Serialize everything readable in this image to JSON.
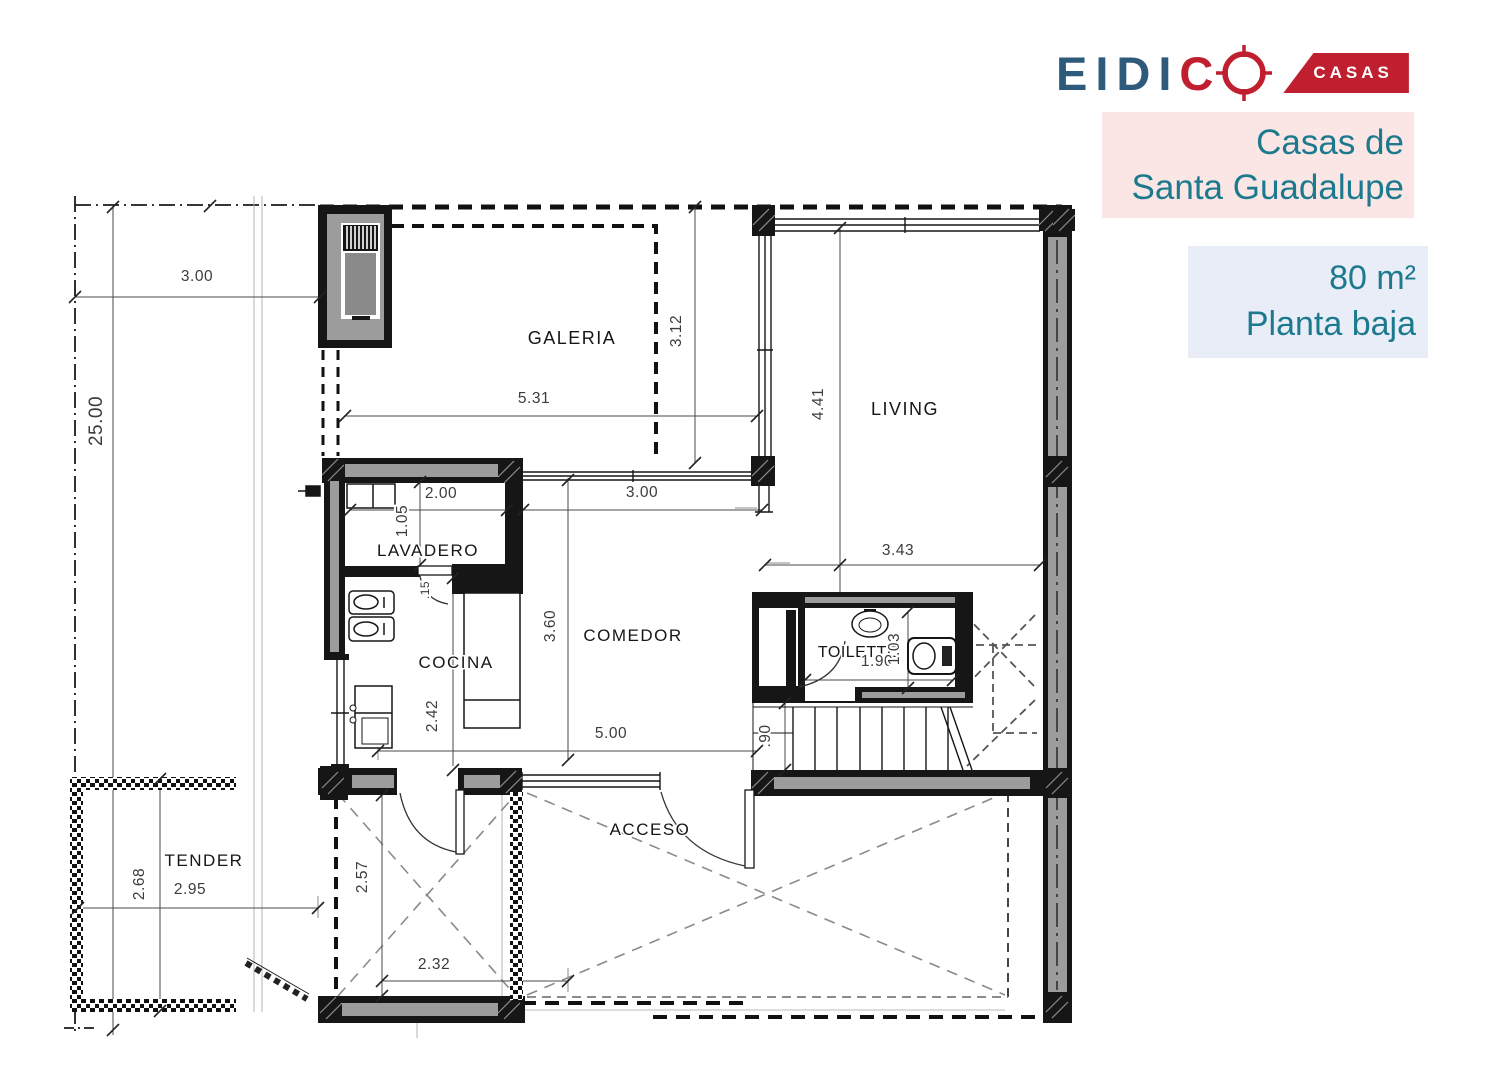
{
  "brand": {
    "logo_text_primary": "EIDI",
    "logo_text_accent": "C",
    "logo_badge": "CASAS",
    "colors": {
      "logo_blue": "#2e5b7c",
      "logo_red": "#c01f2f",
      "teal_text": "#1d7a8e",
      "project_box_bg": "#f9e6e5",
      "spec_box_bg": "#e9edf7"
    }
  },
  "project": {
    "title_line1": "Casas de",
    "title_line2": "Santa Guadalupe",
    "area": "80 m²",
    "floor": "Planta baja"
  },
  "plan": {
    "rooms": [
      {
        "label": "GALERIA"
      },
      {
        "label": "LIVING"
      },
      {
        "label": "LAVADERO"
      },
      {
        "label": "COCINA"
      },
      {
        "label": "COMEDOR"
      },
      {
        "label": "TOILETTE"
      },
      {
        "label": "TENDER"
      },
      {
        "label": "ACCESO"
      }
    ],
    "dimensions": [
      {
        "label": "3.00"
      },
      {
        "label": "25.00"
      },
      {
        "label": "5.31"
      },
      {
        "label": "3.12"
      },
      {
        "label": "4.41"
      },
      {
        "label": "2.00"
      },
      {
        "label": "1.05"
      },
      {
        "label": "3.00"
      },
      {
        "label": "3.60"
      },
      {
        "label": "2.42"
      },
      {
        "label": "5.00"
      },
      {
        "label": "3.43"
      },
      {
        "label": "1.90"
      },
      {
        "label": "1.03"
      },
      {
        "label": ".90"
      },
      {
        "label": "2.68"
      },
      {
        "label": "2.95"
      },
      {
        "label": "2.57"
      },
      {
        "label": "2.32"
      },
      {
        "label": ".15"
      }
    ]
  }
}
